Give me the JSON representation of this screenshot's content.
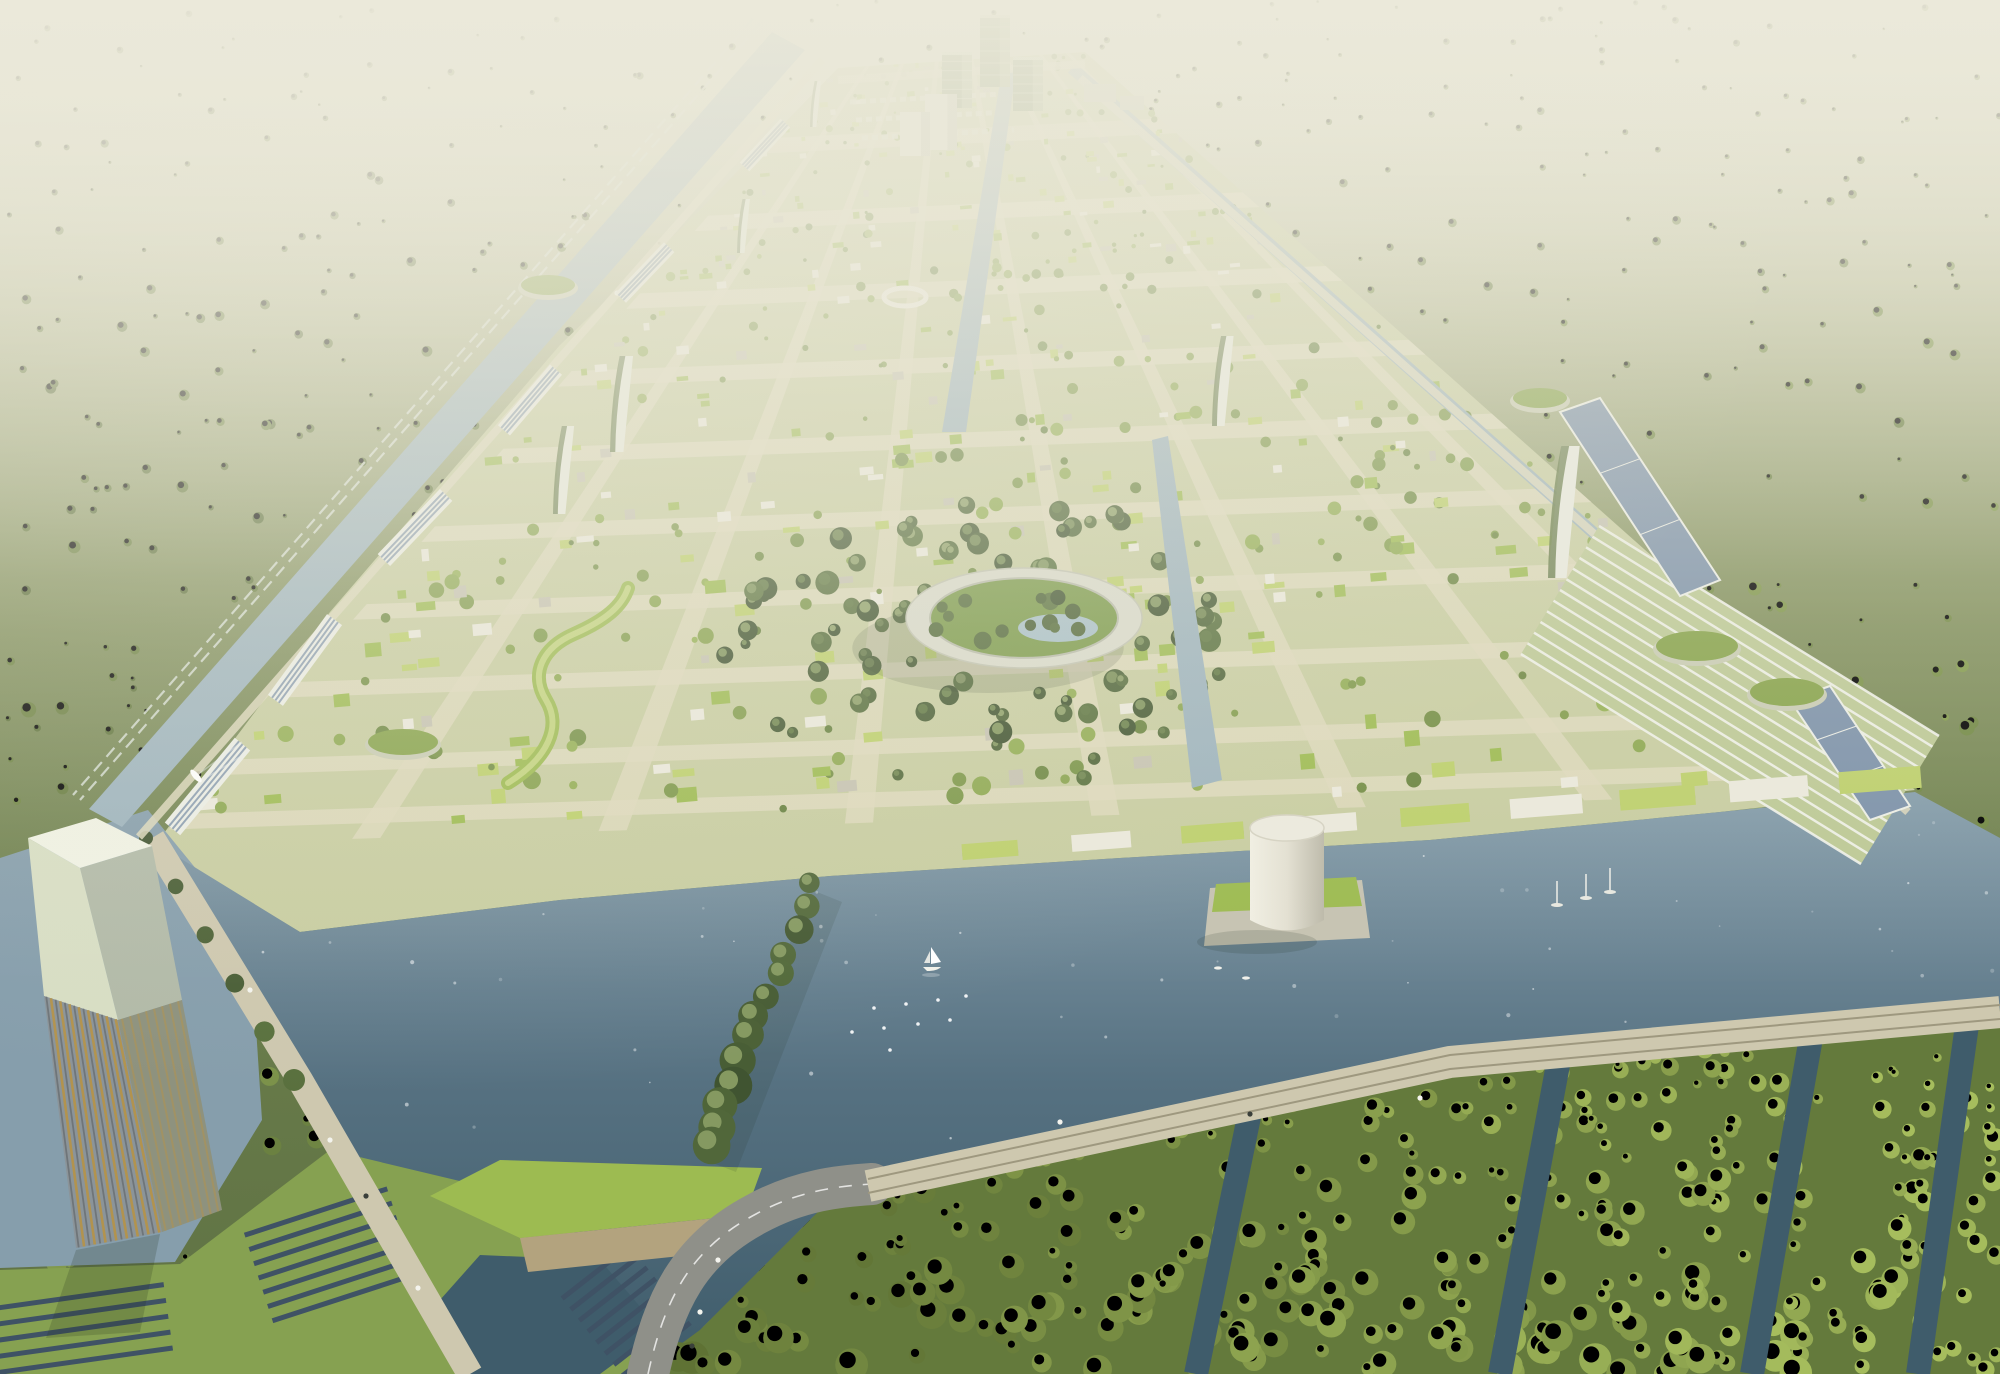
{
  "scene": {
    "w": 2000,
    "h": 1374,
    "seed": 13,
    "palette": {
      "haze": "#ebe9da",
      "forest_dark": "#46572f",
      "forest_bright": "#93ad55",
      "forest_lite": "#e2ecae",
      "water_deep": "#3f5c6b",
      "water": "#567181",
      "water_light": "#869eac",
      "canal": "#9db3bd",
      "city_base": "#c8cda1",
      "street": "#ded9bd",
      "roof_green": "#9dbb51",
      "roof_green2": "#bdd06c",
      "bldg_grey": "#c6c3b2",
      "bldg_white": "#ebe9dc",
      "solar": "#7d92aa",
      "solar_dark": "#3f5265",
      "panel_frame": "#eceee6",
      "gold": "#b5934b",
      "steel": "#8b9499",
      "pale": "#d8dec4",
      "asphalt": "#8f9089",
      "causeway": "#cec8af",
      "track": "#9e987f",
      "shadow": "#22301f",
      "park_dark": "#3f5230",
      "park_lite": "#5d7540",
      "mangrove_dark": "#55682f",
      "mangrove_bright": "#a6bd5d",
      "tree_mid": "#66803f",
      "tree_sun": "#96b155"
    },
    "forest": {
      "count": 1150
    },
    "city": {
      "quad": [
        [
          838,
          68
        ],
        [
          1085,
          52
        ],
        [
          1915,
          790
        ],
        [
          155,
          845
        ]
      ],
      "poly": [
        [
          838,
          68
        ],
        [
          1085,
          52
        ],
        [
          1915,
          790
        ],
        [
          1720,
          812
        ],
        [
          1430,
          840
        ],
        [
          1120,
          858
        ],
        [
          830,
          876
        ],
        [
          560,
          900
        ],
        [
          300,
          932
        ],
        [
          155,
          845
        ],
        [
          330,
          612
        ],
        [
          560,
          345
        ],
        [
          700,
          210
        ]
      ],
      "streets_t": [
        0.1,
        0.2,
        0.3,
        0.4,
        0.5,
        0.6,
        0.7,
        0.8,
        0.9,
        0.97
      ],
      "streets_s": [
        0.12,
        0.26,
        0.4,
        0.54,
        0.68,
        0.82,
        0.93
      ],
      "texture_count": 600,
      "park": {
        "cx": 985,
        "cy": 640,
        "rx": 265,
        "ry": 150,
        "count": 85
      },
      "parking_rows": [
        [
          [
            850,
            102
          ],
          [
            1002,
            94
          ]
        ],
        [
          [
            856,
            120
          ],
          [
            1008,
            112
          ]
        ],
        [
          [
            862,
            138
          ],
          [
            1014,
            130
          ]
        ]
      ]
    },
    "water": {
      "lake": [
        [
          170,
          852
        ],
        [
          300,
          932
        ],
        [
          560,
          900
        ],
        [
          830,
          876
        ],
        [
          1120,
          858
        ],
        [
          1430,
          840
        ],
        [
          1720,
          812
        ],
        [
          1915,
          792
        ],
        [
          2000,
          838
        ],
        [
          2000,
          1010
        ],
        [
          1450,
          1062
        ],
        [
          872,
          1184
        ],
        [
          820,
          1210
        ],
        [
          700,
          1330
        ],
        [
          640,
          1374
        ],
        [
          470,
          1374
        ],
        [
          300,
          1080
        ]
      ],
      "outer": [
        [
          0,
          858
        ],
        [
          148,
          810
        ],
        [
          250,
          935
        ],
        [
          262,
          1120
        ],
        [
          175,
          1262
        ],
        [
          0,
          1268
        ]
      ],
      "left_canal": [
        [
          805,
          50
        ],
        [
          122,
          827
        ],
        [
          89,
          809
        ],
        [
          772,
          32
        ]
      ],
      "right_canal": {
        "from": [
          1072,
          68
        ],
        "to": [
          1900,
          806
        ],
        "width": 12
      },
      "central_canal": [
        [
          1002,
          70
        ],
        [
          1016,
          70
        ],
        [
          966,
          432
        ],
        [
          942,
          432
        ]
      ],
      "mid_canal": [
        [
          1152,
          440
        ],
        [
          1168,
          436
        ],
        [
          1222,
          780
        ],
        [
          1192,
          788
        ]
      ],
      "sparkles": 60
    },
    "mangrove": {
      "zone": [
        [
          640,
          1374
        ],
        [
          700,
          1330
        ],
        [
          820,
          1210
        ],
        [
          872,
          1184
        ],
        [
          1450,
          1060
        ],
        [
          2000,
          1012
        ],
        [
          2000,
          1374
        ]
      ],
      "count": 330,
      "canals": [
        [
          [
            1250,
            1112
          ],
          [
            1196,
            1374
          ]
        ],
        [
          [
            1560,
            1054
          ],
          [
            1500,
            1374
          ]
        ],
        [
          [
            1812,
            1032
          ],
          [
            1752,
            1374
          ]
        ],
        [
          [
            1968,
            1018
          ],
          [
            1918,
            1374
          ]
        ]
      ],
      "canal_width": 24
    },
    "solar_farm": {
      "field": [
        [
          0,
          1270
        ],
        [
          180,
          1264
        ],
        [
          330,
          1150
        ],
        [
          560,
          1205
        ],
        [
          640,
          1374
        ],
        [
          0,
          1374
        ]
      ],
      "pond": [
        [
          480,
          1255
        ],
        [
          600,
          1260
        ],
        [
          660,
          1330
        ],
        [
          600,
          1374
        ],
        [
          470,
          1374
        ],
        [
          440,
          1300
        ]
      ],
      "clusters": [
        {
          "x": 40,
          "y": 1302,
          "rows": 5,
          "len": 250,
          "pitch": 16,
          "angle": -8
        },
        {
          "x": 316,
          "y": 1212,
          "rows": 7,
          "len": 150,
          "pitch": 15,
          "angle": -18
        },
        {
          "x": 596,
          "y": 1272,
          "rows": 8,
          "len": 86,
          "pitch": 14,
          "angle": -38
        }
      ]
    },
    "wedge": {
      "green": [
        [
          430,
          1196
        ],
        [
          500,
          1160
        ],
        [
          762,
          1168
        ],
        [
          745,
          1215
        ],
        [
          520,
          1238
        ]
      ],
      "wall": [
        [
          520,
          1238
        ],
        [
          745,
          1215
        ],
        [
          738,
          1250
        ],
        [
          528,
          1272
        ]
      ]
    },
    "roads": {
      "pier": [
        [
          152,
          838
        ],
        [
          300,
          1080
        ],
        [
          470,
          1374
        ]
      ],
      "pier_width": 26,
      "highway": "M 648,1374 C 664,1302 688,1250 756,1214 C 800,1190 840,1186 872,1184",
      "highway_width": 42,
      "causeway": [
        [
          868,
          1186
        ],
        [
          1450,
          1062
        ],
        [
          2000,
          1012
        ]
      ],
      "causeway_width": 32,
      "rail_left": [
        [
          760,
          24
        ],
        [
          80,
          800
        ]
      ],
      "left_road": [
        [
          822,
          60
        ],
        [
          139,
          837
        ]
      ],
      "top_road": [
        [
          838,
          80
        ],
        [
          1085,
          64
        ]
      ],
      "right_road": [
        [
          1080,
          78
        ],
        [
          1908,
          812
        ]
      ],
      "cars_light": [
        [
          617,
          293
        ],
        [
          412,
          526
        ],
        [
          310,
          643
        ],
        [
          250,
          990
        ],
        [
          330,
          1140
        ],
        [
          418,
          1288
        ],
        [
          700,
          1312
        ],
        [
          718,
          1260
        ],
        [
          1060,
          1122
        ],
        [
          1420,
          1098
        ]
      ],
      "cars_dark": [
        [
          515,
          410
        ],
        [
          366,
          1196
        ],
        [
          692,
          1346
        ],
        [
          1250,
          1114
        ]
      ]
    },
    "landmarks": {
      "ring": {
        "cx": 1024,
        "cy": 618,
        "rx": 118,
        "ry": 50,
        "band": 24,
        "pond": [
          1058,
          628,
          40,
          14
        ],
        "trees": 14
      },
      "plaza_ring": [
        905,
        297,
        21,
        9
      ],
      "cylinder": {
        "cx": 1287,
        "top": 828,
        "rx": 37,
        "ry": 13,
        "h": 92,
        "block": [
          [
            1210,
            888
          ],
          [
            1362,
            880
          ],
          [
            1370,
            938
          ],
          [
            1204,
            946
          ]
        ],
        "block_roof": [
          [
            1216,
            884
          ],
          [
            1356,
            877
          ],
          [
            1362,
            906
          ],
          [
            1212,
            912
          ]
        ]
      },
      "tower": {
        "top": [
          [
            28,
            838
          ],
          [
            96,
            818
          ],
          [
            152,
            846
          ],
          [
            80,
            868
          ]
        ],
        "front_upper": [
          [
            28,
            838
          ],
          [
            80,
            868
          ],
          [
            118,
            1020
          ],
          [
            44,
            996
          ]
        ],
        "front_lower": [
          [
            44,
            996
          ],
          [
            118,
            1020
          ],
          [
            162,
            1232
          ],
          [
            76,
            1248
          ]
        ],
        "side_upper": [
          [
            80,
            868
          ],
          [
            152,
            846
          ],
          [
            182,
            1000
          ],
          [
            118,
            1020
          ]
        ],
        "side_lower": [
          [
            118,
            1020
          ],
          [
            182,
            1000
          ],
          [
            222,
            1210
          ],
          [
            162,
            1232
          ]
        ],
        "stripes": 16,
        "shadow": [
          [
            76,
            1250
          ],
          [
            160,
            1234
          ],
          [
            140,
            1332
          ],
          [
            46,
            1338
          ]
        ]
      },
      "skyline": [
        [
          980,
          15,
          30,
          72,
          "g"
        ],
        [
          942,
          52,
          30,
          56,
          "g"
        ],
        [
          1013,
          57,
          30,
          54,
          "g"
        ],
        [
          925,
          94,
          32,
          56,
          "w"
        ],
        [
          900,
          112,
          30,
          44,
          "w"
        ],
        [
          1084,
          84,
          32,
          18,
          "y"
        ],
        [
          1120,
          96,
          24,
          14,
          "y"
        ]
      ],
      "pylons": [
        [
          810,
          127,
          46
        ],
        [
          737,
          253,
          54
        ],
        [
          610,
          452,
          96
        ],
        [
          553,
          514,
          88
        ],
        [
          1548,
          578,
          132
        ],
        [
          1212,
          426,
          90
        ]
      ],
      "pavilions": [
        [
          403,
          742,
          38,
          15
        ],
        [
          548,
          285,
          30,
          12
        ],
        [
          1697,
          646,
          44,
          17
        ],
        [
          1787,
          692,
          40,
          16
        ],
        [
          1540,
          398,
          30,
          12
        ]
      ],
      "serpentine": "M 508,783 C 548,758 562,726 546,700 C 530,674 542,648 574,634 C 606,620 622,606 628,588",
      "greenhouse": {
        "quad": [
          [
            1599,
            526
          ],
          [
            1939,
            736
          ],
          [
            1861,
            864
          ],
          [
            1521,
            654
          ]
        ],
        "lines": 13
      },
      "solar_strips": [
        [
          [
            1560,
            412
          ],
          [
            1600,
            398
          ],
          [
            1720,
            580
          ],
          [
            1680,
            596
          ]
        ],
        [
          [
            1790,
            700
          ],
          [
            1830,
            686
          ],
          [
            1910,
            806
          ],
          [
            1870,
            820
          ]
        ]
      ],
      "corridor": [
        [
          830,
          75
        ],
        [
          700,
          215
        ],
        [
          590,
          330
        ],
        [
          470,
          470
        ],
        [
          360,
          585
        ],
        [
          250,
          735
        ],
        [
          165,
          838
        ]
      ],
      "shore_row": {
        "from": [
          990,
          850
        ],
        "to": [
          1880,
          780
        ],
        "n": 9
      },
      "peninsula": {
        "from": [
          812,
          884
        ],
        "to": [
          706,
          1150
        ],
        "n": 13,
        "refl": [
          [
            812,
            890
          ],
          [
            842,
            902
          ],
          [
            736,
            1172
          ],
          [
            700,
            1158
          ]
        ]
      }
    },
    "boats": {
      "sail": [
        931,
        967
      ],
      "dots": [
        [
          874,
          1008
        ],
        [
          906,
          1004
        ],
        [
          938,
          1000
        ],
        [
          852,
          1032
        ],
        [
          884,
          1028
        ],
        [
          918,
          1024
        ],
        [
          950,
          1020
        ],
        [
          966,
          996
        ],
        [
          890,
          1050
        ]
      ],
      "moored": [
        [
          1557,
          905
        ],
        [
          1586,
          898
        ],
        [
          1610,
          892
        ]
      ],
      "canal_boat": [
        196,
        776
      ],
      "small": [
        [
          1218,
          968
        ],
        [
          1246,
          978
        ]
      ]
    }
  }
}
